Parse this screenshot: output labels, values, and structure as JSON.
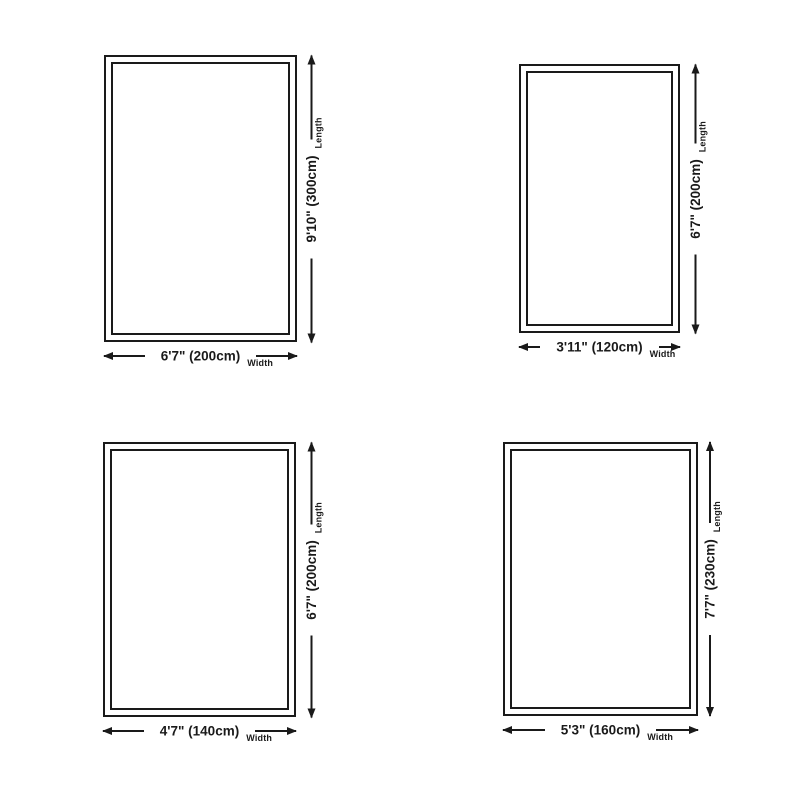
{
  "colors": {
    "background": "#ffffff",
    "ink": "#1a1a1a"
  },
  "diagrams": [
    {
      "position": "top-left",
      "length_value": "9'10\" (300cm)",
      "width_value": "6'7\" (200cm)",
      "length_caption": "Length",
      "width_caption": "Width"
    },
    {
      "position": "top-right",
      "length_value": "6'7\" (200cm)",
      "width_value": "3'11\" (120cm)",
      "length_caption": "Length",
      "width_caption": "Width"
    },
    {
      "position": "bottom-left",
      "length_value": "6'7\" (200cm)",
      "width_value": "4'7\" (140cm)",
      "length_caption": "Length",
      "width_caption": "Width"
    },
    {
      "position": "bottom-right",
      "length_value": "7'7\" (230cm)",
      "width_value": "5'3\" (160cm)",
      "length_caption": "Length",
      "width_caption": "Width"
    }
  ]
}
